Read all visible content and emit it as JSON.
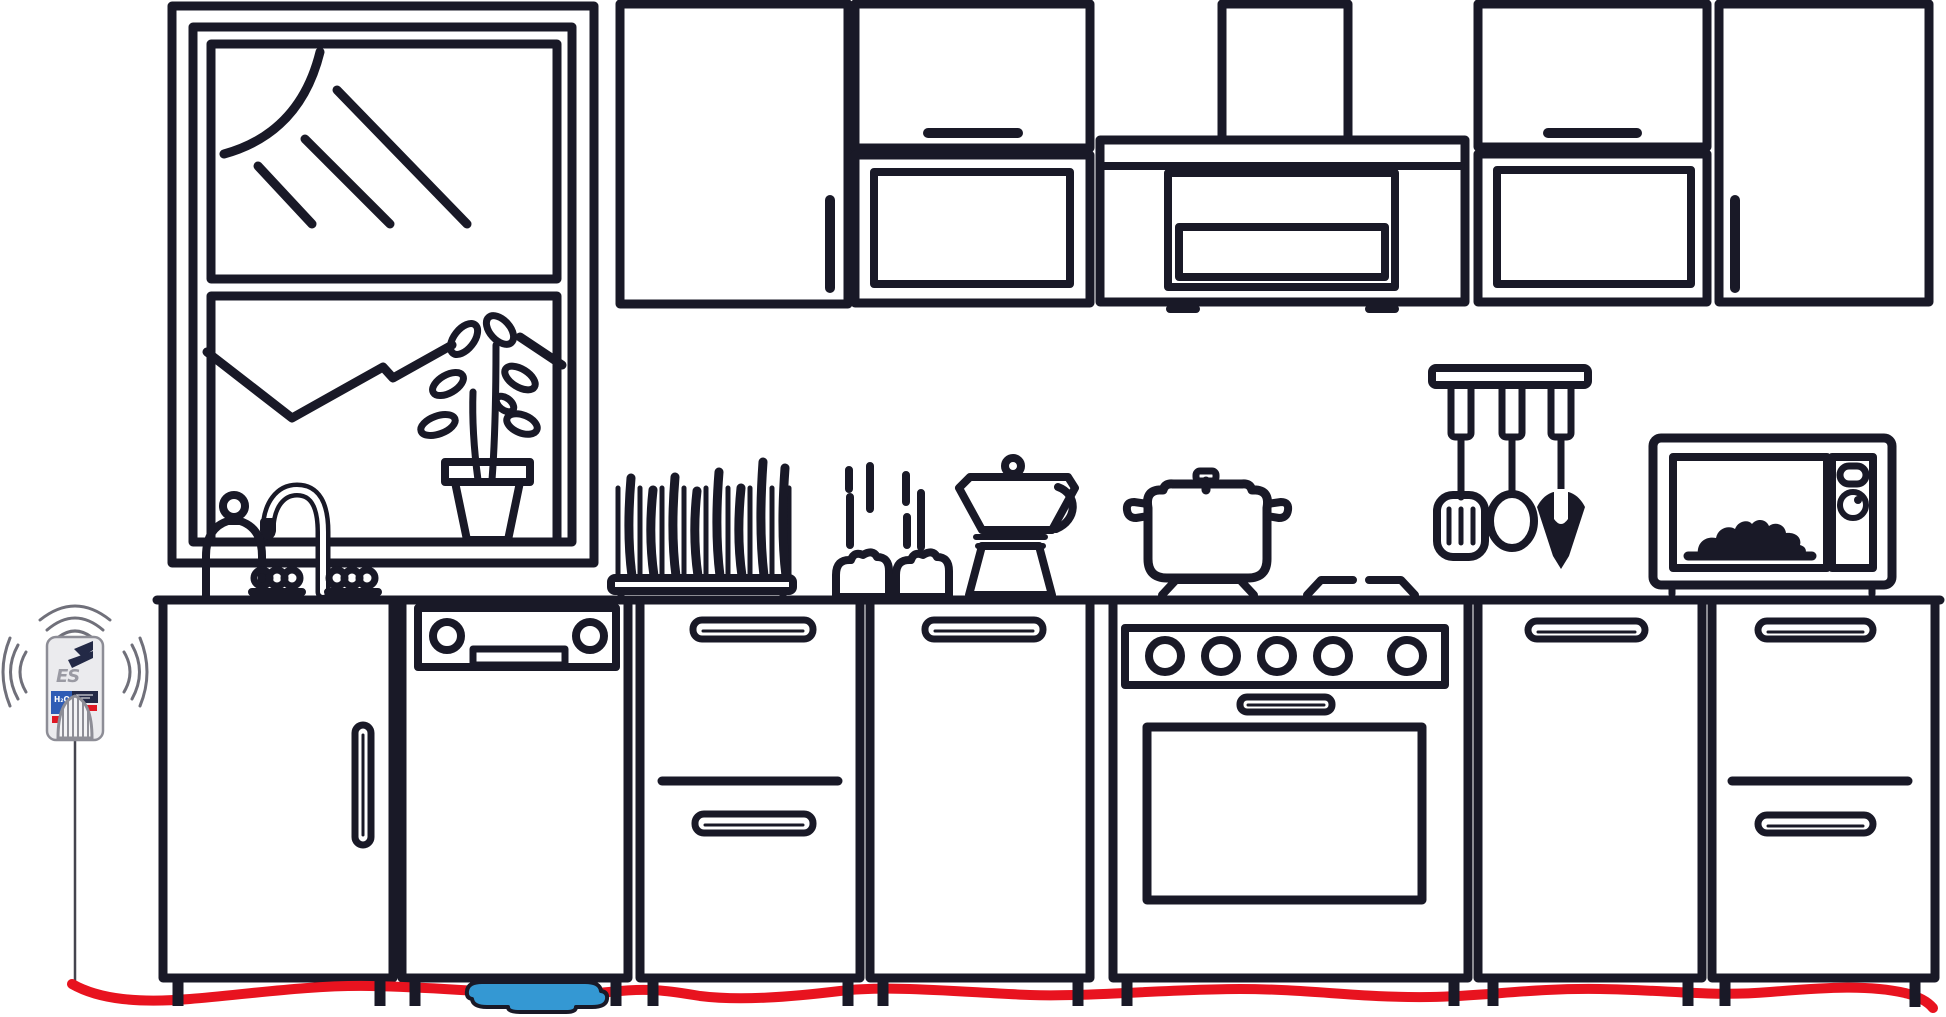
{
  "title": "Kitchen line-art illustration with wireless water leak detector, sensor cable along the floor and a water puddle under the dishwasher",
  "colors": {
    "background": "#ffffff",
    "ink": "#191927",
    "cable": "#e8131f",
    "puddle": "#3498d3",
    "wave": "#70707a",
    "wire": "#44444e",
    "device_body": "#ebebee",
    "device_border": "#8d8d96",
    "device_logo": "#9a9aa3",
    "device_dark": "#232946",
    "device_blue": "#2e5cb5",
    "device_red": "#e01723"
  },
  "device": {
    "brand": "ES",
    "label": "H₂O"
  }
}
